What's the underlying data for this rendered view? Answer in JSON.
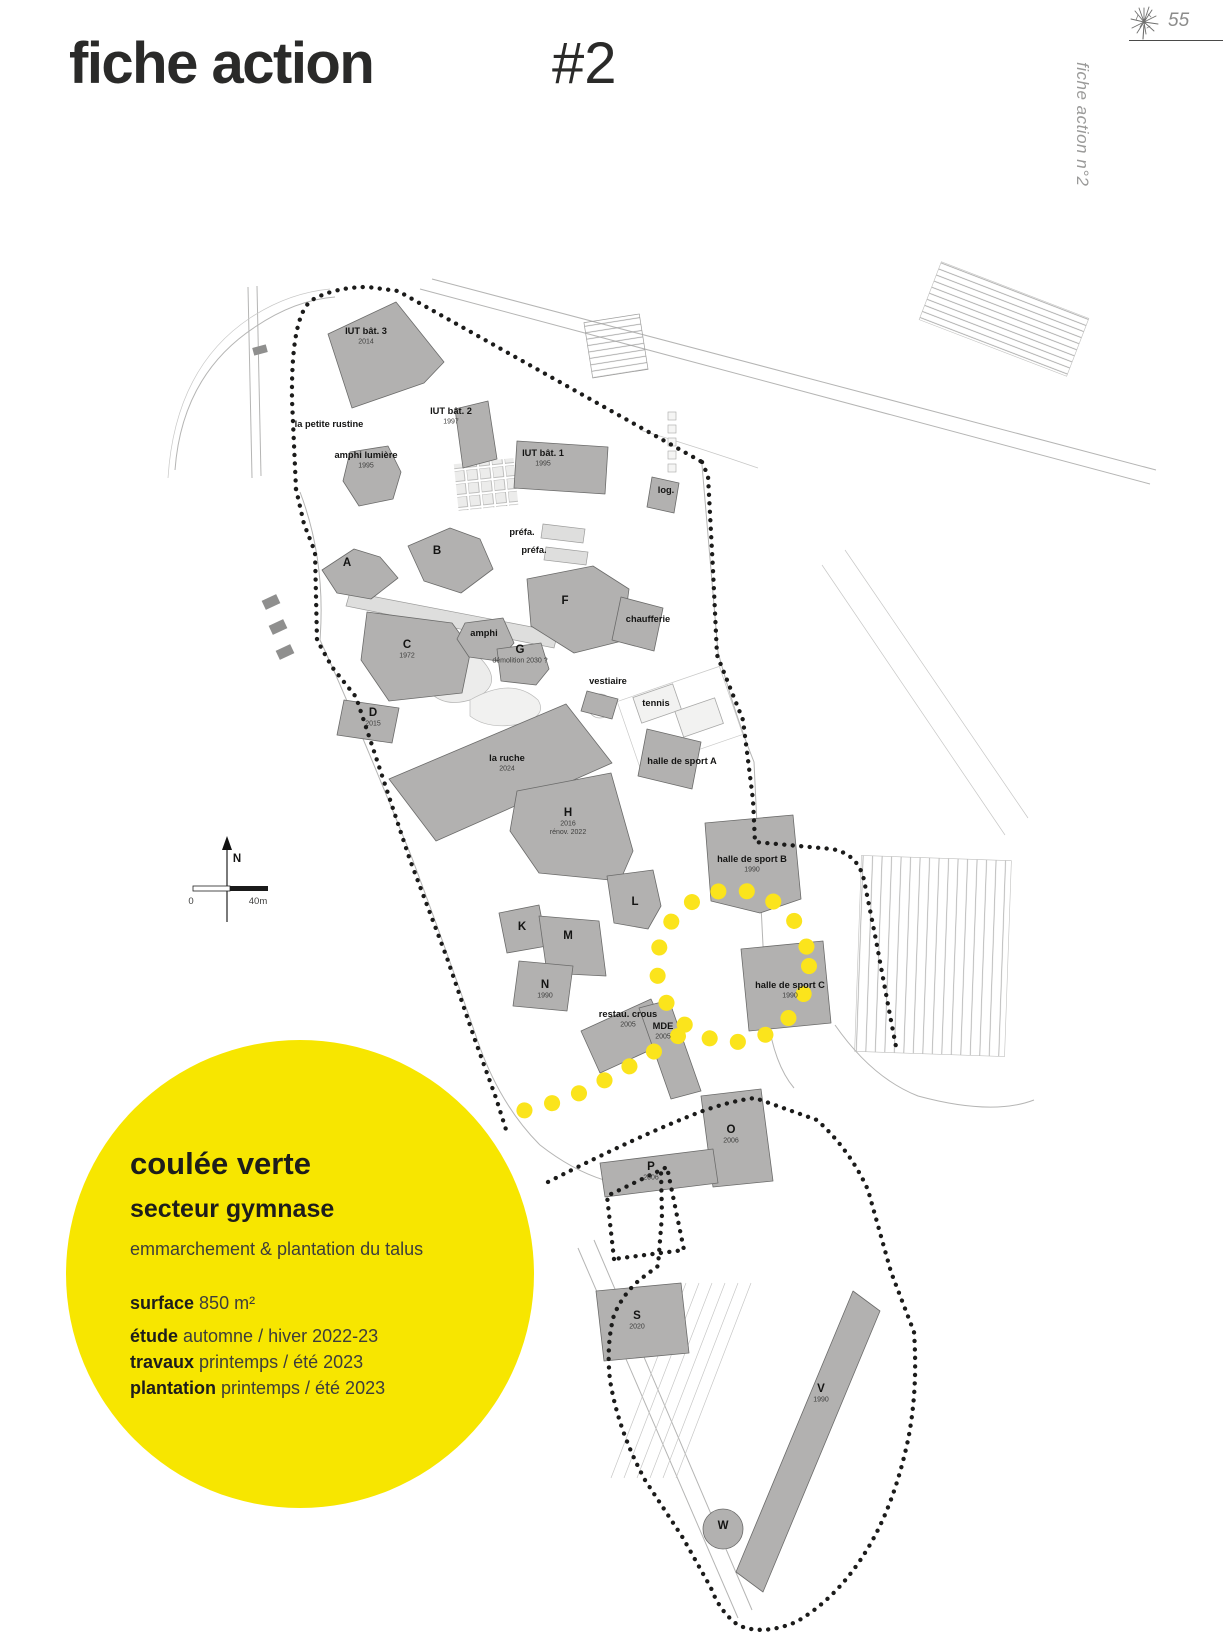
{
  "page": {
    "title": "fiche action",
    "sheet_number": "#2",
    "page_number": "55",
    "side_label": "fiche action n°2"
  },
  "info_circle": {
    "title": "coulée verte",
    "subtitle": "secteur gymnase",
    "description": "emmarchement & plantation du talus",
    "fields": [
      {
        "label": "surface",
        "value": "850 m²"
      },
      {
        "label": "étude",
        "value": "automne / hiver 2022-23"
      },
      {
        "label": "travaux",
        "value": "printemps / été 2023"
      },
      {
        "label": "plantation",
        "value": "printemps / été 2023"
      }
    ],
    "accent_color": "#f7e600"
  },
  "map": {
    "compass_north": "N",
    "scale_start": "0",
    "scale_end": "40m",
    "boundary_color": "#1b1b1a",
    "path_color": "#fbe41c",
    "labels": [
      {
        "text": "IUT bât. 3",
        "subs": [
          "2014"
        ],
        "x": 366,
        "y": 334
      },
      {
        "text": "la petite rustine",
        "subs": [],
        "x": 329,
        "y": 427
      },
      {
        "text": "IUT bât. 2",
        "subs": [
          "1997"
        ],
        "x": 451,
        "y": 414
      },
      {
        "text": "amphi lumière",
        "subs": [
          "1995"
        ],
        "x": 366,
        "y": 458
      },
      {
        "text": "IUT bât. 1",
        "subs": [
          "1995"
        ],
        "x": 543,
        "y": 456
      },
      {
        "text": "log.",
        "subs": [],
        "x": 666,
        "y": 493
      },
      {
        "text": "préfa.",
        "subs": [],
        "x": 522,
        "y": 535
      },
      {
        "text": "préfa.",
        "subs": [],
        "x": 534,
        "y": 553
      },
      {
        "text": "A",
        "subs": [],
        "x": 347,
        "y": 566
      },
      {
        "text": "B",
        "subs": [],
        "x": 437,
        "y": 554
      },
      {
        "text": "F",
        "subs": [],
        "x": 565,
        "y": 604
      },
      {
        "text": "amphi",
        "subs": [],
        "x": 484,
        "y": 636
      },
      {
        "text": "C",
        "subs": [
          "1972"
        ],
        "x": 407,
        "y": 648
      },
      {
        "text": "G",
        "subs": [
          "démolition 2030 ?"
        ],
        "x": 520,
        "y": 653
      },
      {
        "text": "chaufferie",
        "subs": [],
        "x": 648,
        "y": 622
      },
      {
        "text": "vestiaire",
        "subs": [],
        "x": 608,
        "y": 684
      },
      {
        "text": "tennis",
        "subs": [],
        "x": 656,
        "y": 706
      },
      {
        "text": "D",
        "subs": [
          "2015"
        ],
        "x": 373,
        "y": 716
      },
      {
        "text": "la ruche",
        "subs": [
          "2024"
        ],
        "x": 507,
        "y": 761
      },
      {
        "text": "halle de sport A",
        "subs": [],
        "x": 682,
        "y": 764
      },
      {
        "text": "H",
        "subs": [
          "2016",
          "rénov. 2022"
        ],
        "x": 568,
        "y": 816
      },
      {
        "text": "halle de sport B",
        "subs": [
          "1990"
        ],
        "x": 752,
        "y": 862
      },
      {
        "text": "L",
        "subs": [],
        "x": 635,
        "y": 905
      },
      {
        "text": "K",
        "subs": [],
        "x": 522,
        "y": 930
      },
      {
        "text": "M",
        "subs": [],
        "x": 568,
        "y": 939
      },
      {
        "text": "N",
        "subs": [
          "1990"
        ],
        "x": 545,
        "y": 988
      },
      {
        "text": "halle de sport C",
        "subs": [
          "1990"
        ],
        "x": 790,
        "y": 988
      },
      {
        "text": "restau. crous",
        "subs": [
          "2005"
        ],
        "x": 628,
        "y": 1017
      },
      {
        "text": "MDE",
        "subs": [
          "2005"
        ],
        "x": 663,
        "y": 1029
      },
      {
        "text": "O",
        "subs": [
          "2006"
        ],
        "x": 731,
        "y": 1133
      },
      {
        "text": "P",
        "subs": [
          "2006"
        ],
        "x": 651,
        "y": 1170
      },
      {
        "text": "S",
        "subs": [
          "2020"
        ],
        "x": 637,
        "y": 1319
      },
      {
        "text": "V",
        "subs": [
          "1990"
        ],
        "x": 821,
        "y": 1392
      },
      {
        "text": "W",
        "subs": [],
        "x": 723,
        "y": 1529
      }
    ]
  }
}
